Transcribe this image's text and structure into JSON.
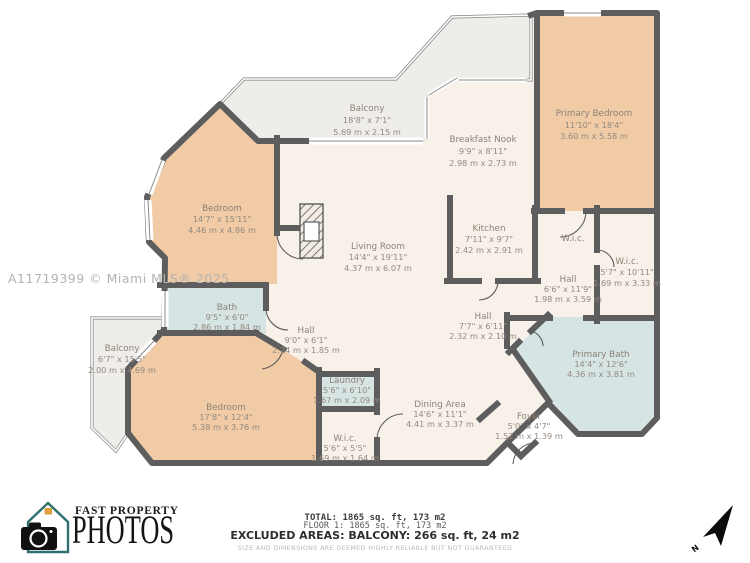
{
  "watermark": "A11719399 © Miami MLS® 2025",
  "colors": {
    "room_warm": "#f0cba6",
    "room_wet": "#d6e4e4",
    "room_neutral": "#f8f1ea",
    "balcony": "#efedea",
    "wall": "#5d5d5d"
  },
  "rooms": {
    "balcony_top": {
      "name": "Balcony",
      "imperial": "18'8\" x 7'1\"",
      "metric": "5.69 m x 2.15 m"
    },
    "breakfast_nook": {
      "name": "Breakfast Nook",
      "imperial": "9'9\" x 8'11\"",
      "metric": "2.98 m x 2.73 m"
    },
    "primary_bedroom": {
      "name": "Primary Bedroom",
      "imperial": "11'10\" x 18'4\"",
      "metric": "3.60 m x 5.58 m"
    },
    "bedroom_upper": {
      "name": "Bedroom",
      "imperial": "14'7\" x 15'11\"",
      "metric": "4.46 m x 4.86 m"
    },
    "living_room": {
      "name": "Living Room",
      "imperial": "14'4\" x 19'11\"",
      "metric": "4.37 m x 6.07 m"
    },
    "kitchen": {
      "name": "Kitchen",
      "imperial": "7'11\" x 9'7\"",
      "metric": "2.42 m x 2.91 m"
    },
    "wic_top": {
      "name": "W.i.c."
    },
    "wic_right": {
      "name": "W.i.c.",
      "imperial": "5'7\" x 10'11\"",
      "metric": "1.69 m x 3.33 m"
    },
    "hall_right": {
      "name": "Hall",
      "imperial": "6'6\" x 11'9\"",
      "metric": "1.98 m x 3.59 m"
    },
    "bath": {
      "name": "Bath",
      "imperial": "9'5\" x 6'0\"",
      "metric": "2.86 m x 1.84 m"
    },
    "hall_mid": {
      "name": "Hall",
      "imperial": "9'0\" x 6'1\"",
      "metric": "2.74 m x 1.85 m"
    },
    "balcony_left": {
      "name": "Balcony",
      "imperial": "6'7\" x 15'5\"",
      "metric": "2.00 m x 4.69 m"
    },
    "bedroom_lower": {
      "name": "Bedroom",
      "imperial": "17'8\" x 12'4\"",
      "metric": "5.38 m x 3.76 m"
    },
    "laundry": {
      "name": "Laundry",
      "imperial": "5'6\" x 6'10\"",
      "metric": "1.67 m x 2.09 m"
    },
    "wic_lower": {
      "name": "W.i.c.",
      "imperial": "5'6\" x 5'5\"",
      "metric": "1.69 m x 1.64 m"
    },
    "hall_lower": {
      "name": "Hall",
      "imperial": "7'7\" x 6'11\"",
      "metric": "2.32 m x 2.10 m"
    },
    "dining": {
      "name": "Dining Area",
      "imperial": "14'6\" x 11'1\"",
      "metric": "4.41 m x 3.37 m"
    },
    "foyer": {
      "name": "Foyer",
      "imperial": "5'0\" x 4'7\"",
      "metric": "1.52 m x 1.39 m"
    },
    "primary_bath": {
      "name": "Primary Bath",
      "imperial": "14'4\" x 12'6\"",
      "metric": "4.36 m x 3.81 m"
    }
  },
  "footer": {
    "total": "TOTAL: 1865 sq. ft, 173 m2",
    "floor": "FLOOR 1: 1865 sq. ft, 173 m2",
    "excluded": "EXCLUDED AREAS: BALCONY: 266 sq. ft, 24 m2",
    "disclaimer": "SIZE AND DIMENSIONS ARE DEEMED HIGHLY RELIABLE BUT NOT GUARANTEED"
  },
  "logo": {
    "line1": "FAST PROPERTY",
    "line2": "PHOTOS"
  },
  "compass": {
    "label": "N"
  }
}
